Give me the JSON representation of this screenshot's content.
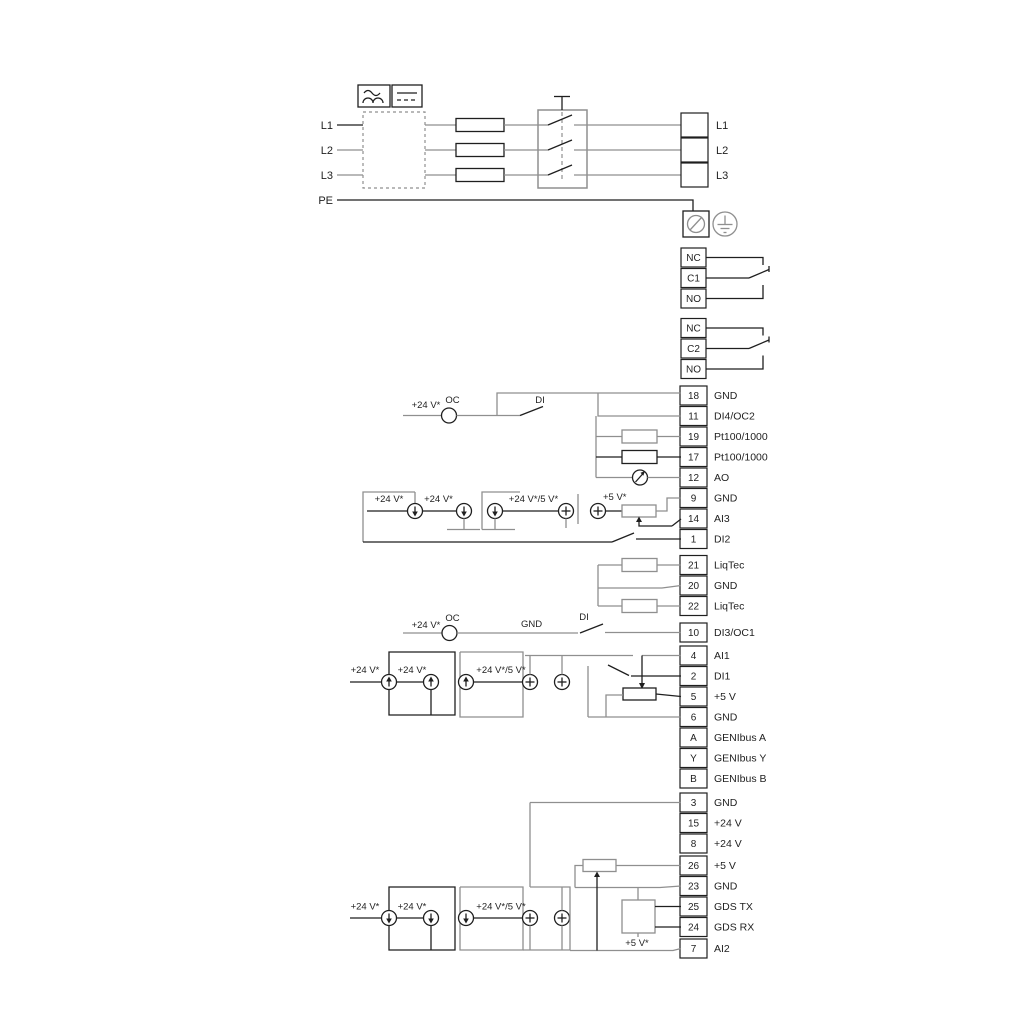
{
  "power_in": [
    {
      "label": "L1"
    },
    {
      "label": "L2"
    },
    {
      "label": "L3"
    },
    {
      "label": "PE"
    }
  ],
  "power_out": [
    {
      "label": "L1"
    },
    {
      "label": "L2"
    },
    {
      "label": "L3"
    }
  ],
  "relay1": [
    {
      "label": "NC"
    },
    {
      "label": "C1"
    },
    {
      "label": "NO"
    }
  ],
  "relay2": [
    {
      "label": "NC"
    },
    {
      "label": "C2"
    },
    {
      "label": "NO"
    }
  ],
  "stripA": [
    {
      "num": "18",
      "label": "GND"
    },
    {
      "num": "11",
      "label": "DI4/OC2"
    },
    {
      "num": "19",
      "label": "Pt100/1000"
    },
    {
      "num": "17",
      "label": "Pt100/1000"
    },
    {
      "num": "12",
      "label": "AO"
    },
    {
      "num": "9",
      "label": "GND"
    },
    {
      "num": "14",
      "label": "AI3"
    },
    {
      "num": "1",
      "label": "DI2"
    }
  ],
  "stripB": [
    {
      "num": "21",
      "label": "LiqTec"
    },
    {
      "num": "20",
      "label": "GND"
    },
    {
      "num": "22",
      "label": "LiqTec"
    }
  ],
  "stripC": [
    {
      "num": "10",
      "label": "DI3/OC1"
    },
    {
      "num": "4",
      "label": "AI1"
    },
    {
      "num": "2",
      "label": "DI1"
    },
    {
      "num": "5",
      "label": "+5 V"
    },
    {
      "num": "6",
      "label": "GND"
    },
    {
      "num": "A",
      "label": "GENIbus A"
    },
    {
      "num": "Y",
      "label": "GENIbus Y"
    },
    {
      "num": "B",
      "label": "GENIbus B"
    }
  ],
  "stripD": [
    {
      "num": "3",
      "label": "GND"
    },
    {
      "num": "15",
      "label": "+24 V"
    },
    {
      "num": "8",
      "label": "+24 V"
    },
    {
      "num": "26",
      "label": "+5 V"
    },
    {
      "num": "23",
      "label": "GND"
    },
    {
      "num": "25",
      "label": "GDS TX"
    },
    {
      "num": "24",
      "label": "GDS RX"
    },
    {
      "num": "7",
      "label": "AI2"
    }
  ],
  "ann": {
    "v24": "+24 V*",
    "v24_5": "+24 V*/5 V*",
    "v5": "+5 V*",
    "oc": "OC",
    "di": "DI",
    "gnd": "GND"
  },
  "colors": {
    "wire_gray": "#8f8f8f",
    "wire_black": "#1f1f1f",
    "background": "#ffffff"
  }
}
